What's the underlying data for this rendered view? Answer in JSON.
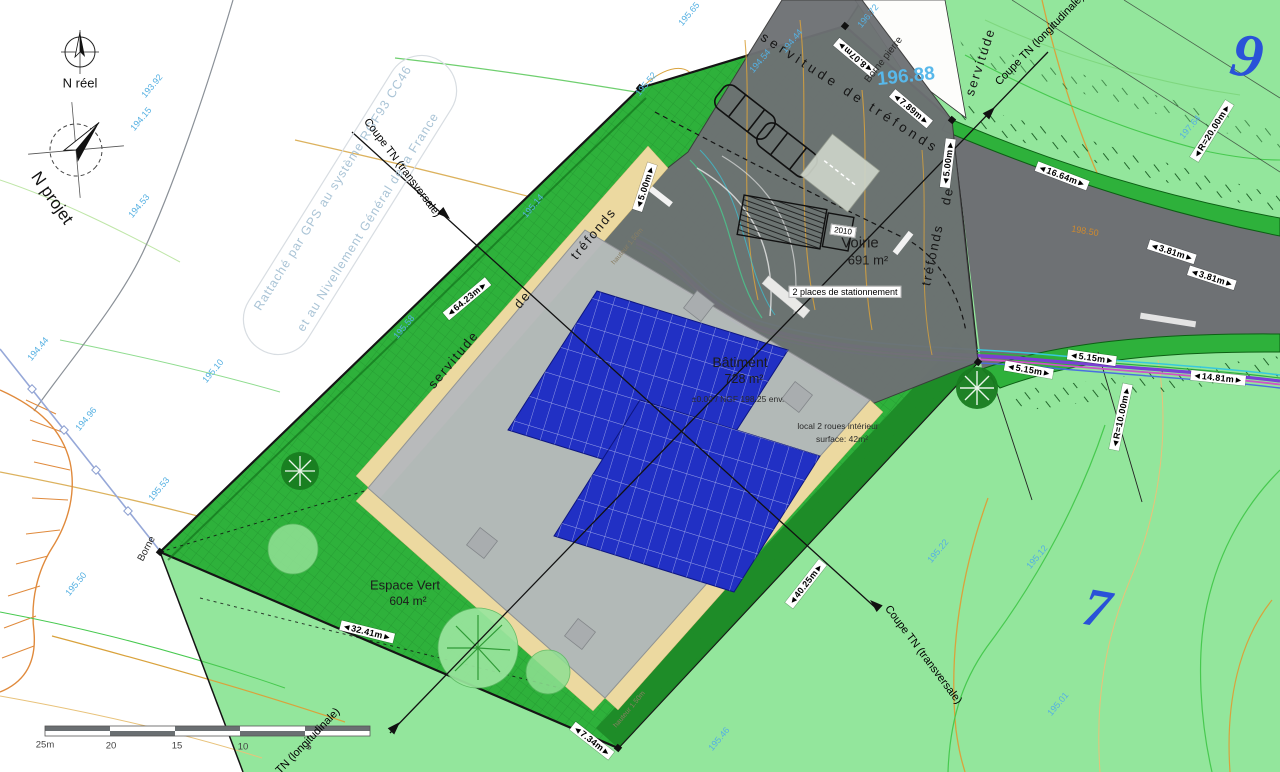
{
  "title": "Plan de masse - projet bâtiment photovoltaïque",
  "scalebar": {
    "labels": [
      "25m",
      "20",
      "15",
      "10",
      "5"
    ]
  },
  "labels": [
    {
      "t": "◄8.07m►",
      "x": 855,
      "y": 57,
      "r": 220,
      "c": "dim",
      "n": "dim-8-07m"
    },
    {
      "t": "◄7.89m►",
      "x": 911,
      "y": 109,
      "r": 40,
      "c": "dim",
      "n": "dim-7-89m"
    },
    {
      "t": "◄5.00m►",
      "x": 645,
      "y": 187,
      "r": -72,
      "c": "dim",
      "n": "dim-5-00m-left"
    },
    {
      "t": "◄5.00m►",
      "x": 948,
      "y": 163,
      "r": -83,
      "c": "dim",
      "n": "dim-5-00m-right"
    },
    {
      "t": "◄16.64m►",
      "x": 1062,
      "y": 176,
      "r": 21,
      "c": "dim",
      "n": "dim-16-64m"
    },
    {
      "t": "◄3.81m►",
      "x": 1172,
      "y": 252,
      "r": 18,
      "c": "dim",
      "n": "dim-3-81m-a"
    },
    {
      "t": "◄3.81m►",
      "x": 1212,
      "y": 278,
      "r": 18,
      "c": "dim",
      "n": "dim-3-81m-b"
    },
    {
      "t": "◄R=20.00m►",
      "x": 1212,
      "y": 131,
      "r": -58,
      "c": "dim",
      "n": "dim-r-20-00m"
    },
    {
      "t": "◄5.15m►",
      "x": 1029,
      "y": 370,
      "r": 10,
      "c": "dim",
      "n": "dim-5-15m-a"
    },
    {
      "t": "◄5.15m►",
      "x": 1092,
      "y": 358,
      "r": 8,
      "c": "dim",
      "n": "dim-5-15m-b"
    },
    {
      "t": "◄14.81m►",
      "x": 1218,
      "y": 378,
      "r": 6,
      "c": "dim",
      "n": "dim-14-81m"
    },
    {
      "t": "◄R=10.00m►",
      "x": 1121,
      "y": 417,
      "r": -78,
      "c": "dim",
      "n": "dim-r-10-00m"
    },
    {
      "t": "◄64.23m►",
      "x": 467,
      "y": 299,
      "r": -40,
      "c": "dim",
      "n": "dim-64-23m"
    },
    {
      "t": "◄32.41m►",
      "x": 367,
      "y": 632,
      "r": 14,
      "c": "dim",
      "n": "dim-32-41m"
    },
    {
      "t": "◄40.25m►",
      "x": 806,
      "y": 584,
      "r": -52,
      "c": "dim",
      "n": "dim-40-25m"
    },
    {
      "t": "◄7.34m►",
      "x": 592,
      "y": 741,
      "r": 38,
      "c": "dim",
      "n": "dim-7-34m"
    },
    {
      "t": "193.92",
      "x": 152,
      "y": 86,
      "r": -50,
      "c": "elev",
      "n": "elevation-193-92"
    },
    {
      "t": "194.15",
      "x": 141,
      "y": 119,
      "r": -50,
      "c": "elev",
      "n": "elevation-194-15"
    },
    {
      "t": "194.53",
      "x": 139,
      "y": 206,
      "r": -50,
      "c": "elev",
      "n": "elevation-194-53"
    },
    {
      "t": "194.44",
      "x": 38,
      "y": 349,
      "r": -50,
      "c": "elev",
      "n": "elevation-194-44"
    },
    {
      "t": "194.96",
      "x": 86,
      "y": 419,
      "r": -50,
      "c": "elev",
      "n": "elevation-194-96"
    },
    {
      "t": "195.53",
      "x": 159,
      "y": 489,
      "r": -50,
      "c": "elev",
      "n": "elevation-195-53"
    },
    {
      "t": "195.50",
      "x": 76,
      "y": 584,
      "r": -50,
      "c": "elev",
      "n": "elevation-195-50"
    },
    {
      "t": "195.10",
      "x": 213,
      "y": 371,
      "r": -50,
      "c": "elev",
      "n": "elevation-195-10"
    },
    {
      "t": "195.58",
      "x": 404,
      "y": 327,
      "r": -50,
      "c": "elev",
      "n": "elevation-195-58"
    },
    {
      "t": "195.14",
      "x": 533,
      "y": 206,
      "r": -50,
      "c": "elev",
      "n": "elevation-195-14"
    },
    {
      "t": "195.52",
      "x": 646,
      "y": 84,
      "r": -50,
      "c": "elev",
      "n": "elevation-195-52"
    },
    {
      "t": "195.65",
      "x": 689,
      "y": 14,
      "r": -50,
      "c": "elev",
      "n": "elevation-195-65"
    },
    {
      "t": "194.54",
      "x": 760,
      "y": 61,
      "r": -50,
      "c": "elev",
      "n": "elevation-194-54"
    },
    {
      "t": "194.44",
      "x": 792,
      "y": 41,
      "r": -50,
      "c": "elev",
      "n": "elevation-194-44b"
    },
    {
      "t": "196.72",
      "x": 868,
      "y": 16,
      "r": -50,
      "c": "elev",
      "n": "elevation-196-72"
    },
    {
      "t": "195.22",
      "x": 938,
      "y": 551,
      "r": -50,
      "c": "elev",
      "n": "elevation-195-22"
    },
    {
      "t": "195.12",
      "x": 1037,
      "y": 557,
      "r": -50,
      "c": "elev",
      "n": "elevation-195-12"
    },
    {
      "t": "195.01",
      "x": 1058,
      "y": 704,
      "r": -50,
      "c": "elev",
      "n": "elevation-195-01"
    },
    {
      "t": "195.46",
      "x": 719,
      "y": 739,
      "r": -50,
      "c": "elev",
      "n": "elevation-195-46"
    },
    {
      "t": "197.64",
      "x": 1190,
      "y": 127,
      "r": -50,
      "c": "elev",
      "n": "elevation-197-64"
    },
    {
      "t": "196.88",
      "x": 906,
      "y": 77,
      "r": -6,
      "c": "elevbig",
      "n": "elevation-196-88"
    },
    {
      "t": "198.50",
      "x": 1085,
      "y": 231,
      "r": 10,
      "c": "orange",
      "n": "contour-198-50"
    },
    {
      "t": "9",
      "x": 1247,
      "y": 57,
      "r": 10,
      "c": "parcelnum",
      "fs": 62,
      "n": "parcel-number-9"
    },
    {
      "t": "7",
      "x": 1097,
      "y": 608,
      "r": 10,
      "c": "parcelnum",
      "fs": 54,
      "n": "parcel-number-7"
    },
    {
      "t": "N réel",
      "x": 80,
      "y": 84,
      "c": "ntext",
      "n": "label-n-reel"
    },
    {
      "t": "N projet",
      "x": 52,
      "y": 198,
      "r": 55,
      "c": "nbig",
      "n": "label-n-projet"
    },
    {
      "t": "Rattaché par GPS au système RGF93 CC46",
      "x": 333,
      "y": 188,
      "r": -58,
      "c": "water",
      "n": "watermark-line1"
    },
    {
      "t": "et au Nivellement Général de la France",
      "x": 368,
      "y": 222,
      "r": -58,
      "c": "water",
      "n": "watermark-line2"
    },
    {
      "t": "Coupe TN (transversale)",
      "x": 402,
      "y": 168,
      "r": 53,
      "c": "coupe",
      "n": "coupe-transversale-top"
    },
    {
      "t": "Coupe TN (transversale)",
      "x": 923,
      "y": 655,
      "r": 53,
      "c": "coupe",
      "n": "coupe-transversale-bottom"
    },
    {
      "t": "Coupe TN (longitudinale)",
      "x": 1040,
      "y": 40,
      "r": -46,
      "c": "coupe",
      "n": "coupe-longitudinale-top"
    },
    {
      "t": "Coupe TN (longitudinale)",
      "x": 296,
      "y": 754,
      "r": -46,
      "c": "coupe",
      "n": "coupe-longitudinale-bottom"
    },
    {
      "t": "servitude  de  tréfonds",
      "x": 850,
      "y": 93,
      "r": 33,
      "c": "serv",
      "n": "servitude-trefonds-top"
    },
    {
      "t": "servitude",
      "x": 454,
      "y": 360,
      "r": -50,
      "c": "serv2",
      "n": "servitude-left-word1"
    },
    {
      "t": "de",
      "x": 523,
      "y": 300,
      "r": -50,
      "c": "serv2",
      "n": "servitude-left-word2"
    },
    {
      "t": "tréfonds",
      "x": 594,
      "y": 234,
      "r": -50,
      "c": "serv2",
      "n": "servitude-left-word3"
    },
    {
      "t": "servitude",
      "x": 981,
      "y": 62,
      "r": -72,
      "c": "serv2",
      "n": "servitude-right-word1"
    },
    {
      "t": "de",
      "x": 948,
      "y": 196,
      "r": -78,
      "c": "serv2",
      "n": "servitude-right-word2"
    },
    {
      "t": "tréfonds",
      "x": 933,
      "y": 255,
      "r": -78,
      "c": "serv2",
      "n": "servitude-right-word3"
    },
    {
      "t": "Borne pierre",
      "x": 884,
      "y": 60,
      "r": -52,
      "c": "small",
      "n": "label-borne-pierre"
    },
    {
      "t": "Borne",
      "x": 147,
      "y": 549,
      "r": -62,
      "c": "small",
      "n": "label-borne"
    },
    {
      "t": "Voirie",
      "x": 860,
      "y": 243,
      "c": "area",
      "fs": 15,
      "n": "label-voirie"
    },
    {
      "t": "691 m²",
      "x": 868,
      "y": 261,
      "c": "area",
      "fs": 13,
      "n": "label-voirie-area"
    },
    {
      "t": "2 places de stationnement",
      "x": 845,
      "y": 292,
      "c": "box",
      "n": "label-parking"
    },
    {
      "t": "Bâtiment",
      "x": 740,
      "y": 362,
      "c": "area",
      "fs": 14,
      "n": "label-batiment"
    },
    {
      "t": "728 m²",
      "x": 744,
      "y": 379,
      "c": "area",
      "fs": 12.5,
      "n": "label-batiment-area"
    },
    {
      "t": "±0.00 / NGF 198.25 env.",
      "x": 738,
      "y": 400,
      "c": "tiny",
      "n": "label-ngf-level"
    },
    {
      "t": "local 2 roues intérieur",
      "x": 838,
      "y": 427,
      "c": "tiny",
      "n": "label-local-2roues"
    },
    {
      "t": "surface: 42m²",
      "x": 842,
      "y": 440,
      "c": "tiny",
      "n": "label-local-surface"
    },
    {
      "t": "Espace Vert",
      "x": 405,
      "y": 586,
      "c": "area",
      "fs": 13,
      "n": "label-espace-vert"
    },
    {
      "t": "604 m²",
      "x": 408,
      "y": 602,
      "c": "area",
      "fs": 12,
      "n": "label-espace-vert-area"
    },
    {
      "t": "hauteur 1.50m",
      "x": 628,
      "y": 247,
      "r": -50,
      "c": "microtan",
      "n": "label-hauteur-1"
    },
    {
      "t": "hauteur 1.50m",
      "x": 630,
      "y": 710,
      "r": -50,
      "c": "microtan",
      "n": "label-hauteur-2"
    },
    {
      "t": "2010",
      "x": 843,
      "y": 231,
      "r": 8,
      "c": "box",
      "fs": 8,
      "n": "label-truck-2010"
    },
    {
      "t": "25m",
      "x": 45,
      "y": 746,
      "c": "scale",
      "n": "scale-25m"
    },
    {
      "t": "20",
      "x": 111,
      "y": 747,
      "c": "scale",
      "n": "scale-20"
    },
    {
      "t": "15",
      "x": 177,
      "y": 747,
      "c": "scale",
      "n": "scale-15"
    },
    {
      "t": "10",
      "x": 243,
      "y": 748,
      "c": "scale",
      "n": "scale-10"
    },
    {
      "t": "5",
      "x": 309,
      "y": 748,
      "c": "scale",
      "n": "scale-5"
    }
  ]
}
